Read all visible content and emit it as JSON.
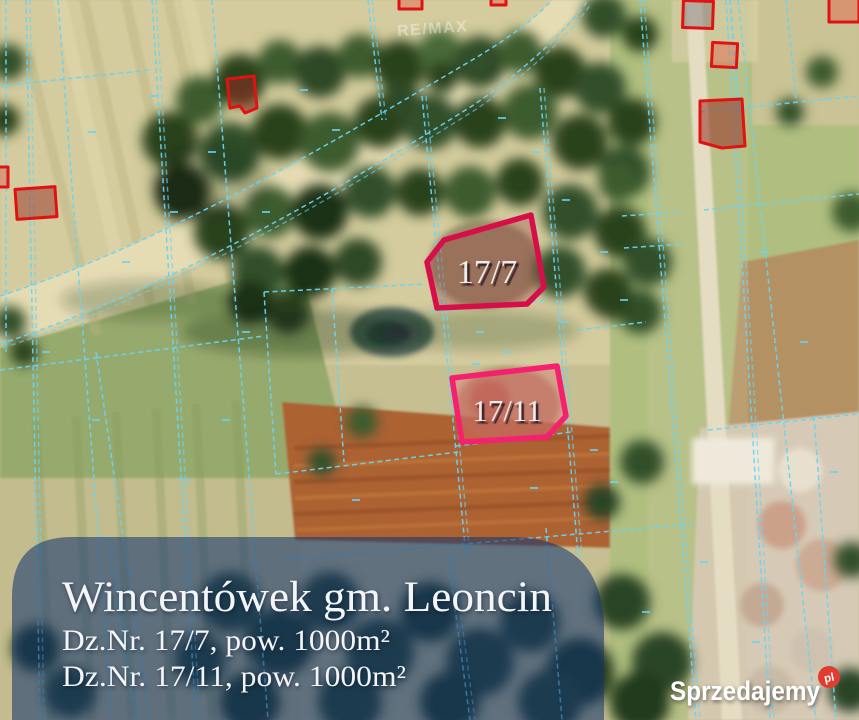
{
  "map": {
    "remax_watermark": "RE/MAX",
    "boundary_color": "#68d4f5",
    "building_color": "#e01212",
    "parcel_77": {
      "label": "17/7",
      "outline": "#d60f4a"
    },
    "parcel_711": {
      "label": "17/11",
      "outline": "#f5216f"
    }
  },
  "panel": {
    "bg": "#11336e",
    "title": "Wincentówek gm. Leoncin",
    "plot1": "Dz.Nr. 17/7, pow. 1000m²",
    "plot2": "Dz.Nr. 17/11, pow. 1000m²"
  },
  "branding": {
    "name": "Sprzedajemy",
    "tld": "pl",
    "badge_color": "#e23b30"
  }
}
